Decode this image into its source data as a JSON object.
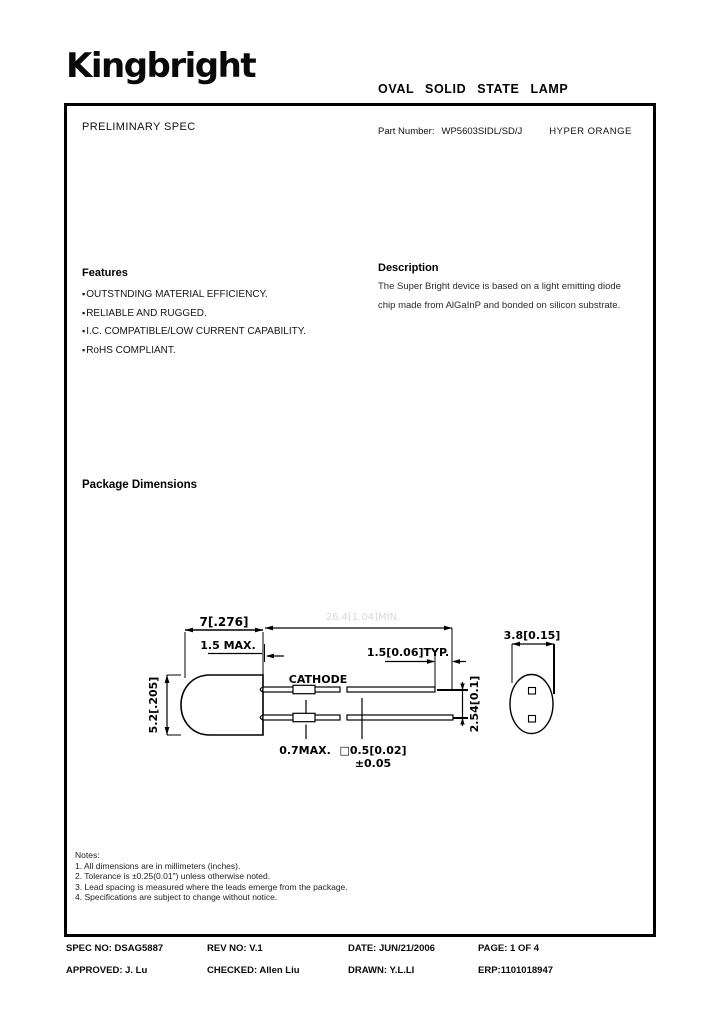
{
  "header": {
    "logo": "Kingbright",
    "title": "OVAL SOLID STATE LAMP"
  },
  "spec_box": {
    "preliminary": "PRELIMINARY SPEC",
    "part_number_label": "Part Number:",
    "part_number": "WP5603SIDL/SD/J",
    "emitted_color": "HYPER ORANGE"
  },
  "features": {
    "heading": "Features",
    "bullet": "▪",
    "items": [
      "OUTSTNDING MATERIAL EFFICIENCY.",
      "RELIABLE AND RUGGED.",
      "I.C. COMPATIBLE/LOW CURRENT CAPABILITY.",
      "RoHS COMPLIANT."
    ]
  },
  "description": {
    "heading": "Description",
    "lines": [
      "The Super Bright device is based on a light emitting diode",
      "chip made from AlGaInP and bonded on silicon substrate."
    ]
  },
  "drawing": {
    "heading": "Package Dimensions",
    "dim_body_width": "7[.276]",
    "dim_flange": "1.5 MAX.",
    "dim_body_height": "5.2[.205]",
    "label_cathode": "CATHODE",
    "dim_lead_tip": "1.5[0.06]TYP.",
    "dim_lead_pitch": "2.54[0.1]",
    "dim_kink": "0.7MAX.",
    "dim_lead_cross": "□0.5[0.02]",
    "dim_lead_cross_tol": "±0.05",
    "dim_oval_width": "3.8[0.15]",
    "dim_lead_length_faint": "26.4[1.04]MIN."
  },
  "notes": {
    "heading": "Notes:",
    "items": [
      "1. All dimensions are in millimeters (inches).",
      "2. Tolerance is ±0.25(0.01\") unless otherwise noted.",
      "3. Lead spacing is measured where the leads emerge from the package.",
      "4. Specifications are subject to change without notice."
    ]
  },
  "footer": {
    "spec_no": "SPEC NO: DSAG5887",
    "rev_no": "REV NO: V.1",
    "date": "DATE: JUN/21/2006",
    "page": "PAGE:  1 OF 4",
    "approved": "APPROVED: J. Lu",
    "checked": "CHECKED: Allen Liu",
    "drawn": "DRAWN: Y.L.LI",
    "erp": "ERP:1101018947"
  }
}
